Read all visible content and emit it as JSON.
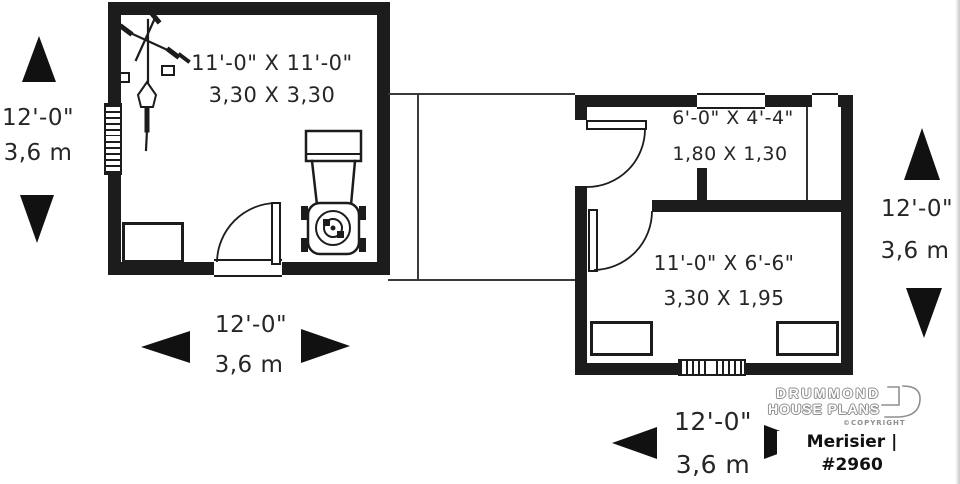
{
  "rooms": {
    "garage": {
      "imperial": "11'-0\" X 11'-0\"",
      "metric": "3,30 X 3,30"
    },
    "small_storage": {
      "imperial": "6'-0\" X 4'-4\"",
      "metric": "1,80 X 1,30"
    },
    "large_storage": {
      "imperial": "11'-0\" X 6'-6\"",
      "metric": "3,30 X 1,95"
    }
  },
  "dims": {
    "left_vertical": {
      "imperial": "12'-0\"",
      "metric": "3,6 m"
    },
    "bottom_left": {
      "imperial": "12'-0\"",
      "metric": "3,6 m"
    },
    "right_vertical": {
      "imperial": "12'-0\"",
      "metric": "3,6 m"
    },
    "bottom_right": {
      "imperial": "12'-0\"",
      "metric": "3,6 m"
    }
  },
  "branding": {
    "logo_line1": "DRUMMOND",
    "logo_line2": "HOUSE PLANS",
    "copyright_label": "©COPYRIGHT",
    "plan_name": "Merisier | #2960"
  },
  "icons": {
    "bicycle": "bicycle-icon",
    "lawn_mower": "lawn-mower-icon"
  },
  "colors": {
    "ink": "#1c1c1c",
    "logo_gray": "#8f8f8f",
    "background": "#ffffff"
  }
}
